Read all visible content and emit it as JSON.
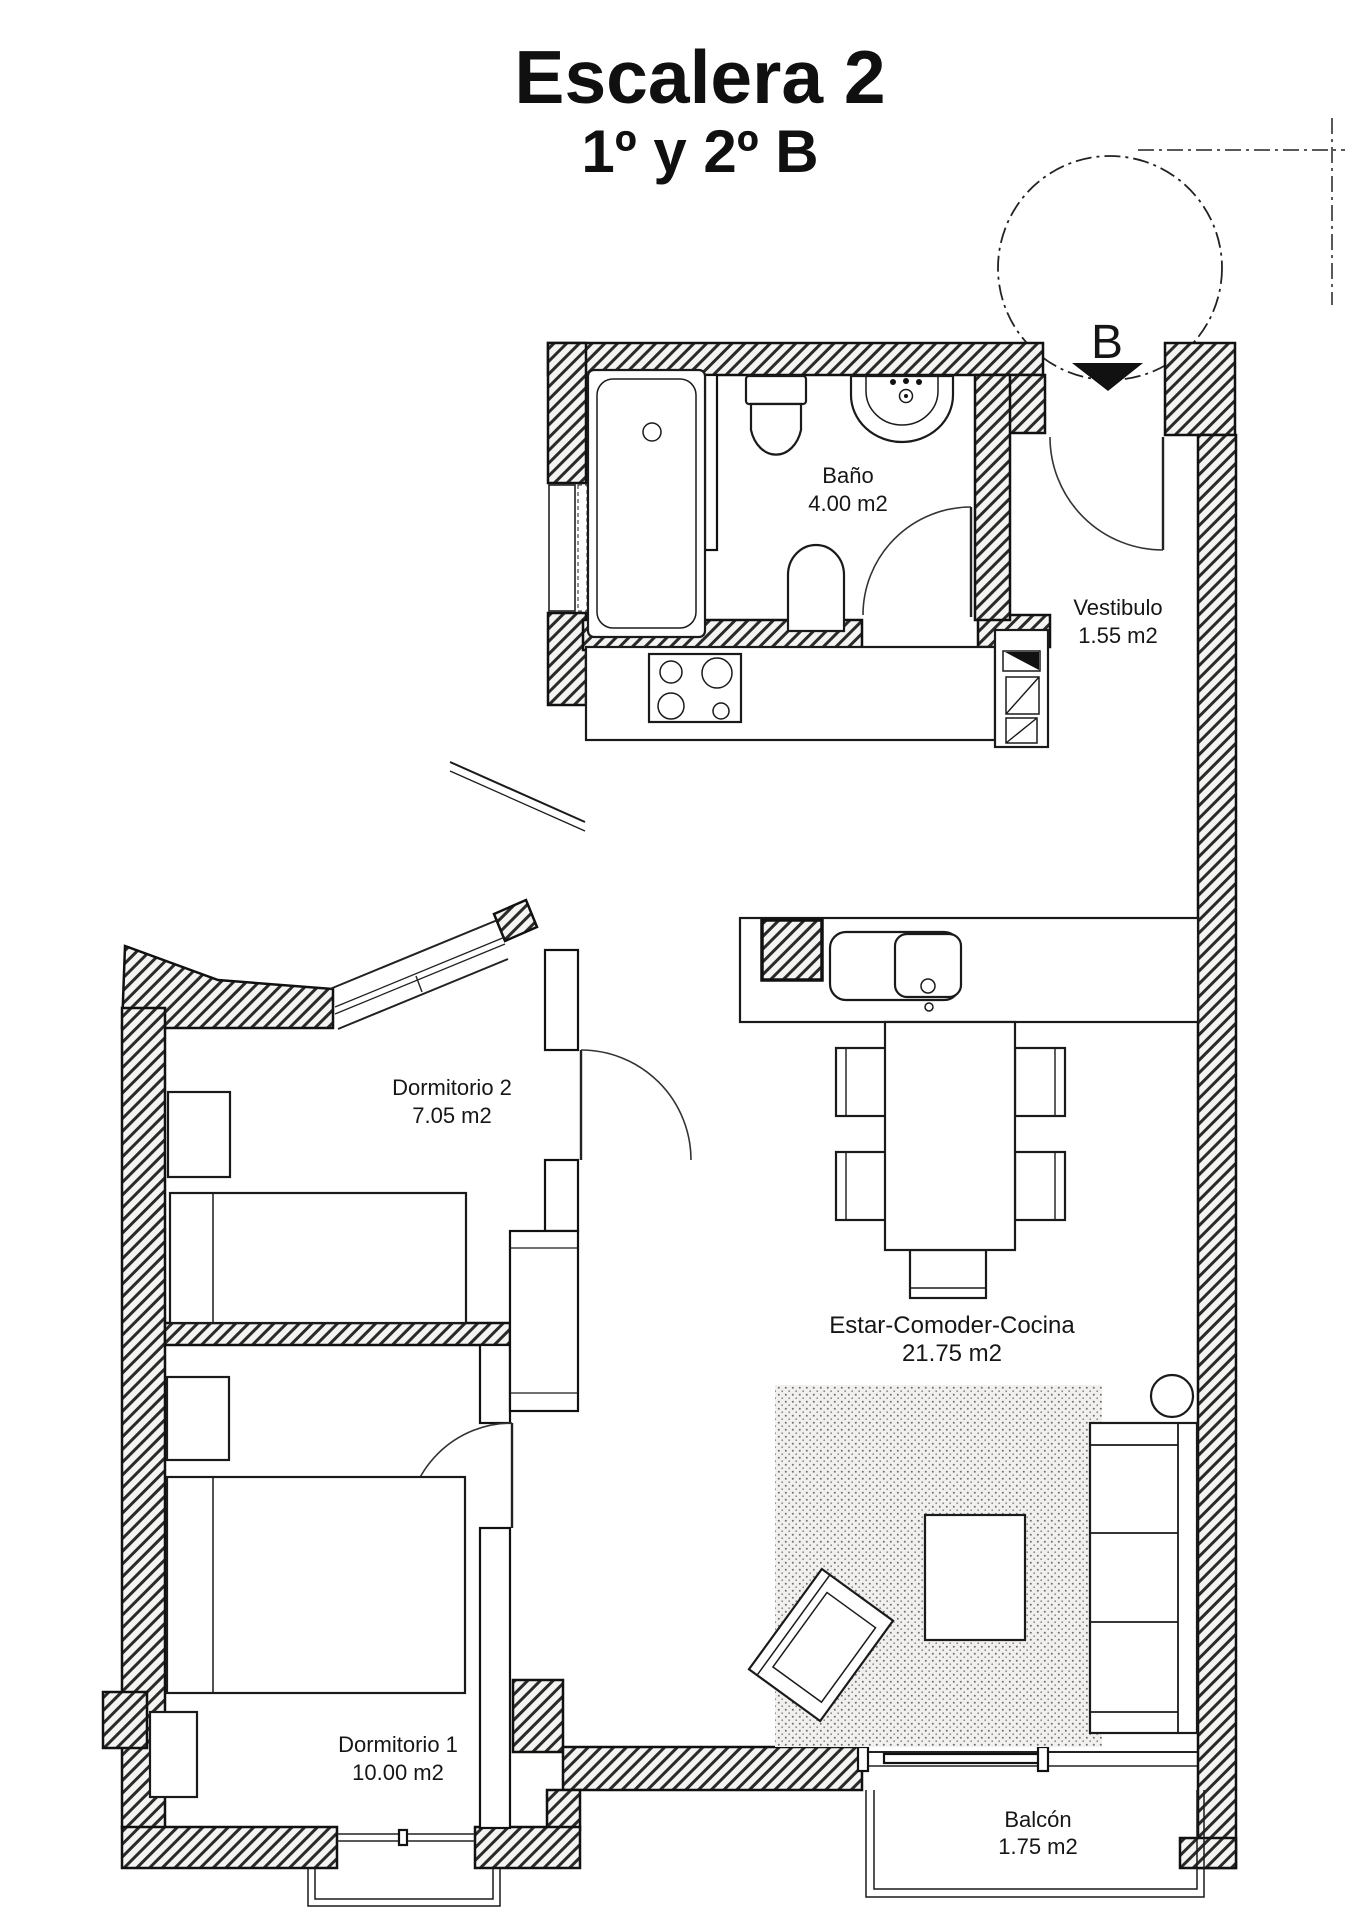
{
  "title": {
    "line1": "Escalera 2",
    "line2": "1º y 2º B"
  },
  "entrance": {
    "label": "B"
  },
  "rooms": {
    "bano": {
      "name": "Baño",
      "area": "4.00 m2"
    },
    "vestibulo": {
      "name": "Vestibulo",
      "area": "1.55 m2"
    },
    "dormitorio2": {
      "name": "Dormitorio 2",
      "area": "7.05 m2"
    },
    "estar": {
      "name": "Estar-Comoder-Cocina",
      "area": "21.75 m2"
    },
    "dormitorio1": {
      "name": "Dormitorio 1",
      "area": "10.00 m2"
    },
    "balcon": {
      "name": "Balcón",
      "area": "1.75 m2"
    }
  },
  "colors": {
    "ink": "#111111",
    "paper": "#ffffff"
  }
}
